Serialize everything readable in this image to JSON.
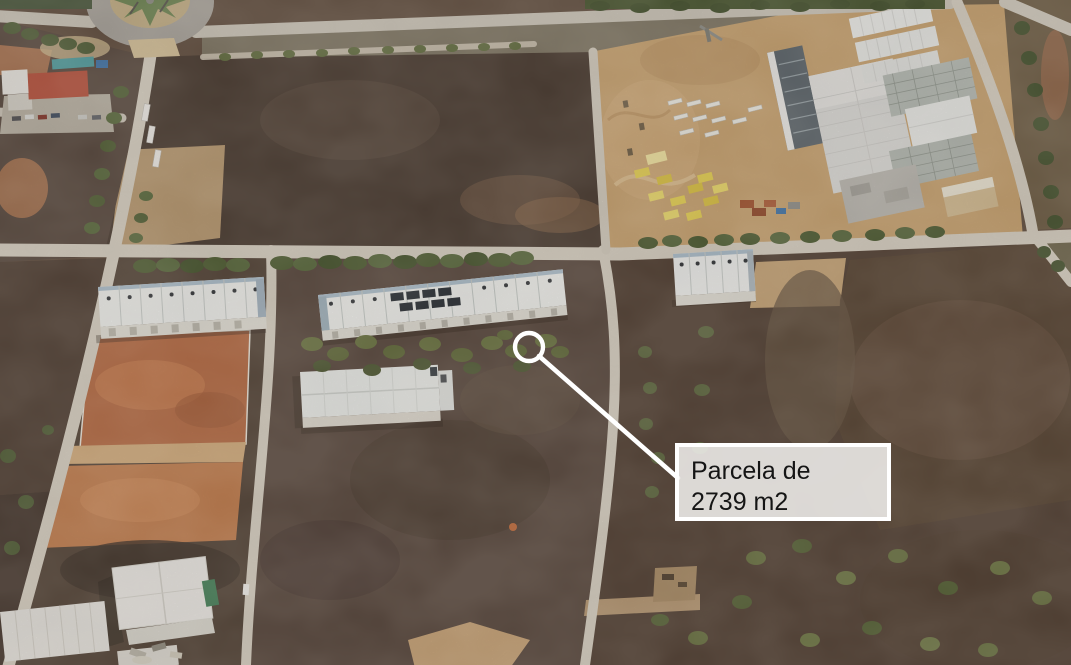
{
  "annotation": {
    "line1": "Parcela de",
    "line2": "2739 m2",
    "marker_icon": "circle-outline",
    "colors": {
      "marker_stroke": "#ffffff",
      "leader_line": "#ffffff",
      "label_background": "#f0efed",
      "label_border": "#ffffff",
      "label_text": "#151515"
    }
  }
}
